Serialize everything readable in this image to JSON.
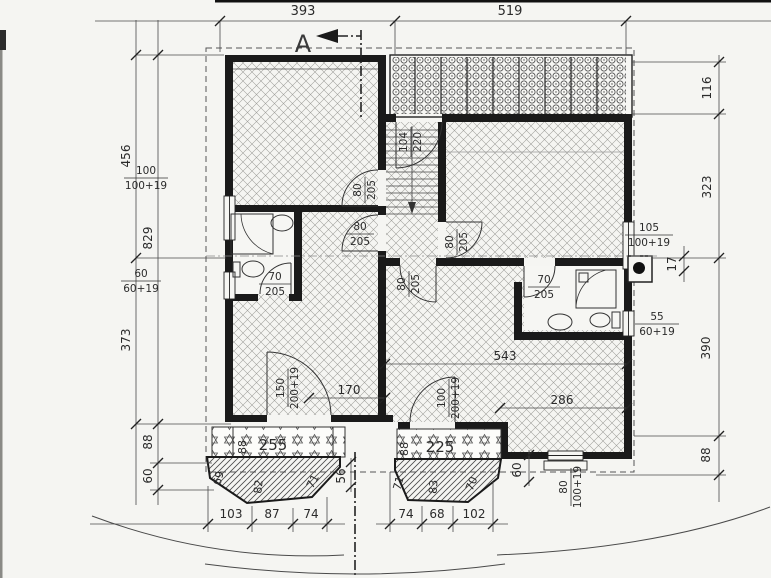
{
  "drawing": {
    "section": {
      "label": "A"
    },
    "dims": {
      "top": [
        "393",
        "519"
      ],
      "left": [
        "456",
        "829",
        "373",
        "88",
        "60"
      ],
      "right": [
        "116",
        "323",
        "17",
        "390",
        "88"
      ],
      "bottom_left": [
        "103",
        "87",
        "74"
      ],
      "bottom_right": [
        "74",
        "68",
        "102"
      ],
      "interior": [
        "543",
        "286",
        "170",
        "56",
        "60"
      ]
    },
    "openings": {
      "win_left_upper": [
        "100",
        "100+19"
      ],
      "win_left_lower": [
        "60",
        "60+19"
      ],
      "win_right_upper": [
        "105",
        "100+19"
      ],
      "win_right_lower": [
        "55",
        "60+19"
      ],
      "win_bottom_right": [
        "80",
        "100+19"
      ],
      "door_stair": [
        "104",
        "220"
      ],
      "door_left_room": [
        "80",
        "205"
      ],
      "door_hall_left": [
        "80",
        "205"
      ],
      "door_right_room": [
        "80",
        "205"
      ],
      "door_hall_bottom": [
        "80",
        "205"
      ],
      "door_bath_left": [
        "70",
        "205"
      ],
      "door_bath_right": [
        "70",
        "205"
      ],
      "door_terrace_left": [
        "150",
        "200+19"
      ],
      "door_terrace_right": [
        "100",
        "200+19"
      ]
    },
    "bays": {
      "left": {
        "faces": [
          "69",
          "82",
          "71"
        ],
        "window": "255",
        "sill": "88"
      },
      "right": {
        "faces": [
          "71",
          "83",
          "70"
        ],
        "window": "225",
        "sill": "88"
      }
    }
  }
}
